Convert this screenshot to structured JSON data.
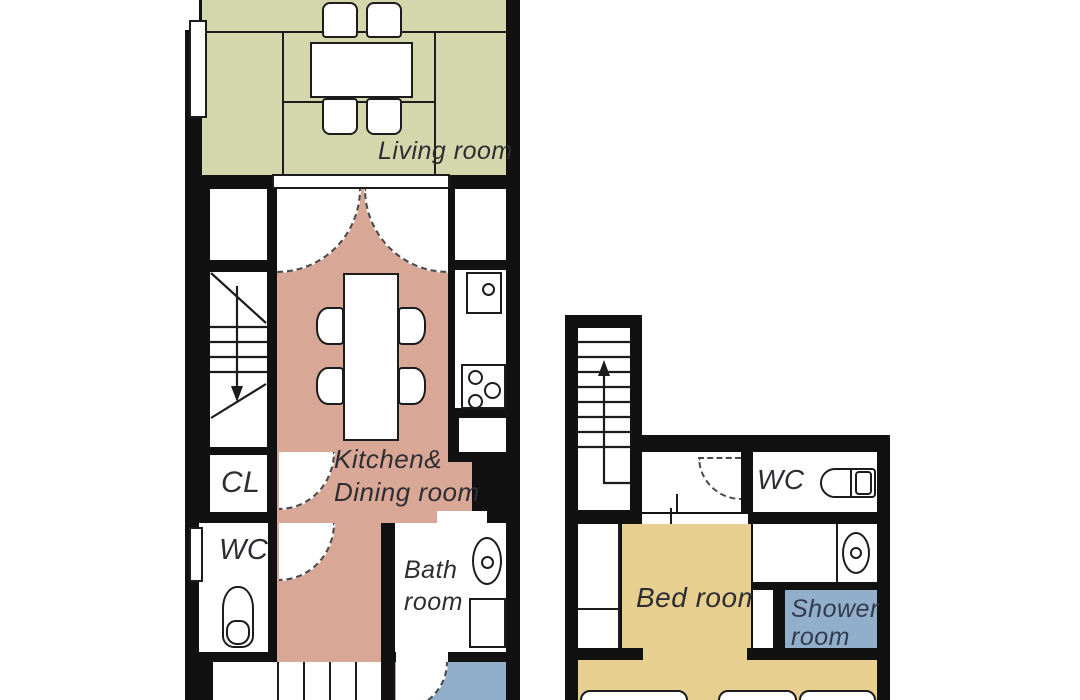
{
  "colors": {
    "living": "#d3d7ab",
    "kitchen": "#d8a795",
    "bedroom": "#e7cf8f",
    "water": "#91aecb",
    "wall": "#111111",
    "label": "#2e2d33",
    "shower_label": "#333b4e"
  },
  "floor1": {
    "living": "Living room",
    "kitchen_line1": "Kitchen&",
    "kitchen_line2": "Dining room",
    "closet": "CL",
    "wc": "WC",
    "bath_line1": "Bath",
    "bath_line2": "room"
  },
  "floor2": {
    "wc": "WC",
    "bedroom": "Bed room",
    "shower_line1": "Shower",
    "shower_line2": "room"
  }
}
